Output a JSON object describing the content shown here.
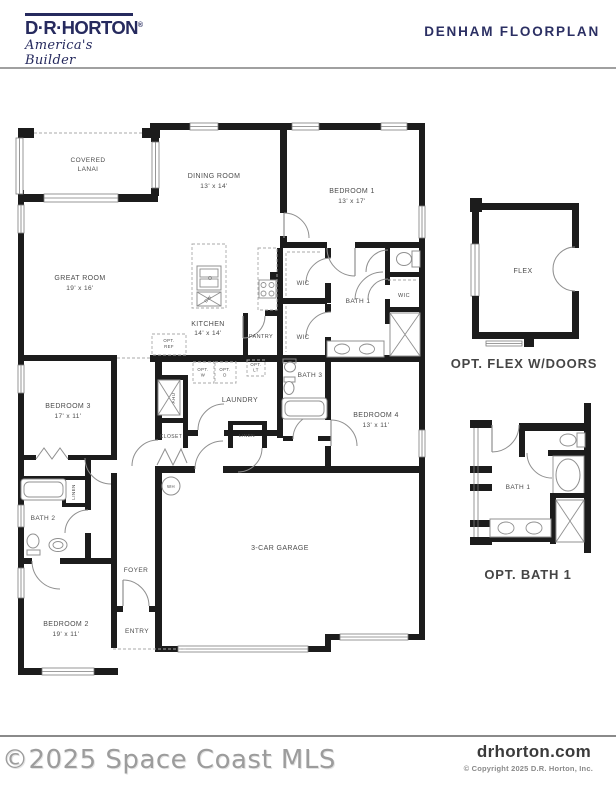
{
  "header": {
    "logo": {
      "brand": "D·R·HORTON",
      "reg": "®",
      "tagline": "America's Builder"
    },
    "title": "DENHAM FLOORPLAN"
  },
  "plan": {
    "lanai1": "COVERED",
    "lanai2": "LANAI",
    "dining": "DINING ROOM",
    "dining_dims": "13' x 14'",
    "bedroom1": "BEDROOM 1",
    "bedroom1_dims": "13' x 17'",
    "great": "GREAT ROOM",
    "great_dims": "19' x 16'",
    "kitchen": "KITCHEN",
    "kitchen_dims": "14' x 14'",
    "pantry": "PANTRY",
    "wic_a": "WIC",
    "wic_b": "WIC",
    "wic_c": "WIC",
    "bath1": "BATH 1",
    "bath3": "BATH 3",
    "laundry": "LAUNDRY",
    "opt_ref1": "OPT.",
    "opt_ref2": "REF",
    "opt_w1": "OPT.",
    "opt_w2": "W",
    "opt_d1": "OPT.",
    "opt_d2": "D",
    "opt_lt1": "OPT.",
    "opt_lt2": "LT",
    "ahu": "AHU",
    "closet": "CLOSET",
    "linen_hall": "LINEN",
    "linen_bath2": "LINEN",
    "bedroom3": "BEDROOM 3",
    "bedroom3_dims": "17' x 11'",
    "bedroom4": "BEDROOM 4",
    "bedroom4_dims": "13' x 11'",
    "bath2": "BATH 2",
    "foyer": "FOYER",
    "entry": "ENTRY",
    "bedroom2": "BEDROOM 2",
    "bedroom2_dims": "19' x 11'",
    "garage": "3-CAR GARAGE",
    "wh": "WH",
    "dw": "DW"
  },
  "insets": {
    "flex_room": "FLEX",
    "flex_caption": "OPT. FLEX W/DOORS",
    "optbath_room": "BATH 1",
    "optbath_caption": "OPT. BATH 1"
  },
  "footer": {
    "watermark": "©2025 Space Coast MLS",
    "website": "drhorton.com",
    "copyright": "© Copyright 2025 D.R. Horton, Inc."
  },
  "colors": {
    "navy": "#2b2f63",
    "wall": "#1c1c1c",
    "fixture": "#909090",
    "watermark": "#9c9c9c"
  }
}
